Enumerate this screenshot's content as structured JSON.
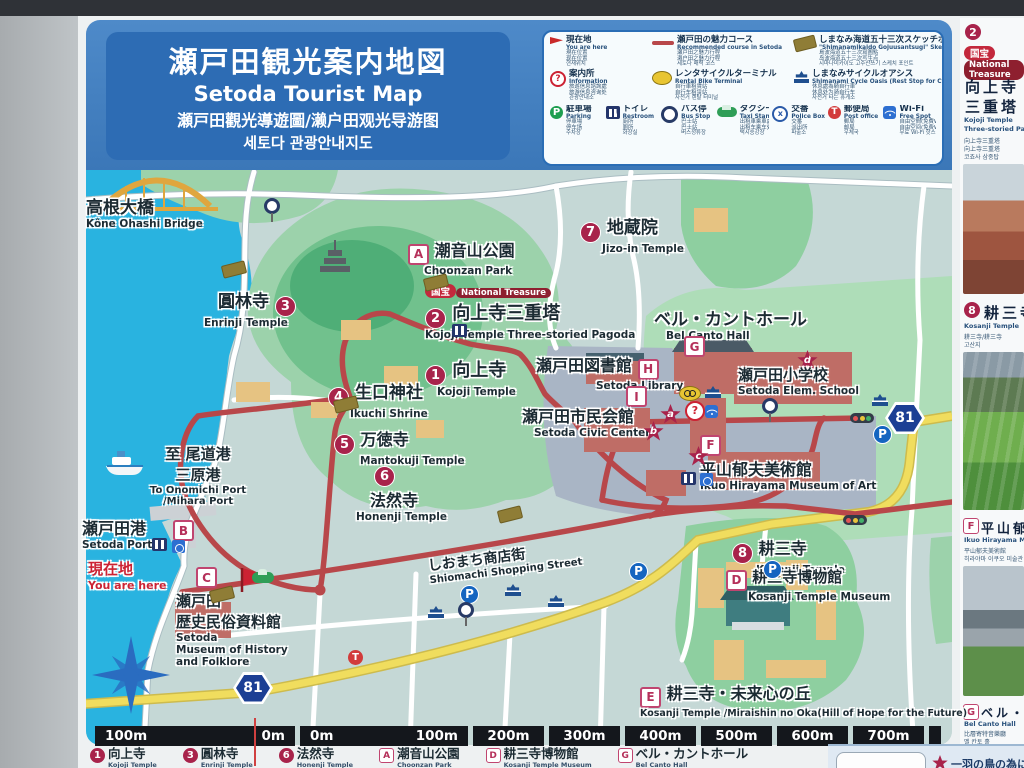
{
  "title": {
    "jp": "瀬戸田観光案内地図",
    "en": "Setoda Tourist Map",
    "zh": "瀬戸田觀光導遊圖/濑户田观光导游图",
    "ko": "세토다 관광안내지도"
  },
  "legend": {
    "main": [
      {
        "icon": "you-are-here",
        "jp": "現在地",
        "en": "You are here",
        "sub": {
          "0": "現在位置",
          "1": "现在位置",
          "2": "현재위치"
        }
      },
      {
        "icon": "course-line",
        "jp": "瀬戸田の魅力コース",
        "en": "Recommended course in Setoda",
        "sub": {
          "0": "瀬戸田之魅力行程",
          "1": "濑户田之魅力行程",
          "2": "세토다 매력 코스"
        }
      },
      {
        "icon": "sketch-point",
        "jp": "しまなみ海道五十三次スケッチポイント",
        "en": "\"Shimanamikaido Gojuusantsugi\" Sketch Point of Ikuo Hirayama",
        "sub": {
          "0": "島波海道五十三次寫圖點",
          "1": "岛波海道五十三次写生点",
          "2": "시마나미카이도 고주산쓰기 스케치 포인트"
        }
      },
      {
        "icon": "information",
        "jp": "案内所",
        "en": "Information",
        "sub": {
          "0": "旅遊信息諮詢處",
          "1": "旅游信息咨询处",
          "2": "관광안내소"
        }
      },
      {
        "icon": "rental-bike",
        "jp": "レンタサイクルターミナル",
        "en": "Rental Bike Terminal",
        "sub": {
          "0": "自行車租賃站",
          "1": "自行车租赁站",
          "2": "자전거 렌탈 터미널"
        }
      },
      {
        "icon": "cycle-oasis",
        "jp": "しまなみサイクルオアシス",
        "en": "Shimanami Cycle Oasis (Rest Stop for Cyclists)",
        "sub": {
          "0": "休息處為騎自行車",
          "1": "休息处为骑自行车",
          "2": "자전거 타는 휴게소"
        }
      }
    ],
    "small": [
      {
        "icon": "parking",
        "jp": "駐車場",
        "en": "Parking",
        "sub": {
          "0": "停車場",
          "1": "停车场",
          "2": "주차장"
        }
      },
      {
        "icon": "restroom",
        "jp": "トイレ",
        "en": "Restroom",
        "sub": {
          "0": "廁所",
          "1": "厕所",
          "2": "화장실"
        }
      },
      {
        "icon": "bus-stop",
        "jp": "バス停",
        "en": "Bus Stop",
        "sub": {
          "0": "巴士站",
          "1": "巴士站",
          "2": "버스정류장"
        }
      },
      {
        "icon": "taxi",
        "jp": "タクシー",
        "en": "Taxi Stand",
        "sub": {
          "0": "出租車乘車處",
          "1": "出租车乘车处",
          "2": "택시승강장"
        }
      },
      {
        "icon": "police-box",
        "jp": "交番",
        "en": "Police Box",
        "sub": {
          "0": "交番",
          "1": "派出所",
          "2": "파출소"
        }
      },
      {
        "icon": "post-office",
        "jp": "郵便局",
        "en": "Post office",
        "sub": {
          "0": "郵局",
          "1": "邮局",
          "2": "우체국"
        }
      },
      {
        "icon": "wifi",
        "jp": "Wi-Fi",
        "en": "Free Spot",
        "sub": {
          "0": "自由空間(免費Wi-Fi)",
          "1": "自由空间(免费Wi-Fi)",
          "2": "무료 Wi-Fi 핫스팟"
        }
      }
    ]
  },
  "map": {
    "route_badge": "81",
    "labels": {
      "bridge": {
        "jp": "高根大橋",
        "en": "Kône Ohashi Bridge"
      },
      "ports": {
        "l1": "至 尾道港",
        "l2": "三原港",
        "l3": "To Onomichi Port",
        "l4": "/Mihara Port"
      },
      "enrinji": {
        "jp": "圓林寺",
        "num": "3",
        "en": "Enrinji Temple"
      },
      "choonzan": {
        "badge": "A",
        "jp": "潮音山公園",
        "en": "Choonzan Park"
      },
      "pagoda": {
        "b1": "国宝",
        "b2": "National Treasure",
        "num": "2",
        "jp": "向上寺三重塔",
        "en": "Kojoji Temple Three-storied Pagoda"
      },
      "kojoji": {
        "num": "1",
        "jp": "向上寺",
        "en": "Kojoji Temple"
      },
      "ikuchi": {
        "num": "4",
        "jp": "生口神社",
        "en": "Ikuchi Shrine"
      },
      "mantokuji": {
        "num": "5",
        "jp": "万徳寺",
        "en": "Mantokuji Temple"
      },
      "honenji": {
        "num": "6",
        "jp": "法然寺",
        "en": "Honenji Temple"
      },
      "jizoin": {
        "num": "7",
        "jp": "地蔵院",
        "en": "Jizo-in Temple"
      },
      "library": {
        "jp": "瀬戸田図書館",
        "badge": "H",
        "en": "Setoda Library"
      },
      "civic": {
        "jp": "瀬戸田市民会館",
        "badge": "I",
        "en": "Setoda Civic Center"
      },
      "belcanto": {
        "jp": "ベル・カントホール",
        "en": "Bel Canto Hall",
        "badge": "G"
      },
      "school": {
        "jp": "瀬戸田小学校",
        "en": "Setoda Elem. School",
        "star": "d"
      },
      "museum": {
        "badge": "F",
        "jp": "平山郁夫美術館",
        "en": "Ikuo Hirayama Museum of Art"
      },
      "port": {
        "jp": "瀬戸田港",
        "en": "Setoda Port",
        "badge": "B"
      },
      "here": {
        "jp": "現在地",
        "en": "You are here"
      },
      "cbadge": "C",
      "history": {
        "jp1": "瀬戸田",
        "jp2": "歴史民俗資料館",
        "en1": "Setoda",
        "en2": "Museum of History",
        "en3": "and Folklore"
      },
      "shopping": {
        "jp": "しおまち商店街",
        "en": "Shiomachi Shopping Street"
      },
      "kosanji": {
        "num": "8",
        "jp": "耕三寺",
        "en": "Kosanji Temple"
      },
      "kosanji_museum": {
        "badge": "D",
        "jp": "耕三寺博物館",
        "en": "Kosanji Temple Museum"
      },
      "miraishin": {
        "badge": "E",
        "jp": "耕三寺・未来心の丘",
        "en": "Kosanji Temple /Miraishin no Oka(Hill of Hope for the Future)"
      },
      "stars": {
        "a": "a",
        "b": "b",
        "c": "c",
        "d": "d"
      }
    }
  },
  "scalebar": {
    "pair_left": {
      "0": "100m",
      "1": "0m"
    },
    "pair_right": {
      "0": "0m",
      "1": "100m"
    },
    "boxes": [
      "200m",
      "300m",
      "400m",
      "500m",
      "600m",
      "700m"
    ]
  },
  "footer": {
    "items": [
      {
        "badge": "1",
        "style": "num",
        "jp": "向上寺",
        "en": "Kojoji Temple"
      },
      {
        "badge": "3",
        "style": "num",
        "jp": "圓林寺",
        "en": "Enrinji Temple"
      },
      {
        "badge": "6",
        "style": "num",
        "jp": "法然寺",
        "en": "Honenji Temple"
      },
      {
        "badge": "A",
        "style": "sq",
        "jp": "潮音山公園",
        "en": "Choonzan Park"
      },
      {
        "badge": "D",
        "style": "sq",
        "jp": "耕三寺博物館",
        "en": "Kosanji Temple Museum"
      },
      {
        "badge": "G",
        "style": "sq",
        "jp": "ベル・カントホール",
        "en": "Bel Canto Hall"
      }
    ],
    "star_note": "一羽の鳥の為に"
  },
  "sidebar": {
    "e1": {
      "num": "2",
      "t1": "国宝",
      "t2": "National Treasure",
      "jp1": "向上寺",
      "jp2": "三重塔",
      "en1": "Kojoji Temple",
      "en2": "Three-storied Pagoda",
      "s1": "向上寺三重塔",
      "s2": "向上寺三重塔",
      "s3": "코죠사 삼중탑"
    },
    "e2": {
      "num": "8",
      "jp": "耕三寺",
      "en": "Kosanji Temple",
      "s1": "耕三寺/耕三寺",
      "s2": "고산지"
    },
    "e3": {
      "badge": "F",
      "jp": "平山郁夫美術館",
      "en": "Ikuo Hirayama Museum of Art",
      "s1": "平山郁夫美術館",
      "s2": "히라야마 이쿠오 미술관"
    },
    "e4": {
      "badge": "G",
      "jp": "ベル・カントホール",
      "en": "Bel Canto Hall",
      "s1": "比層寄特音樂廳",
      "s2": "벨 칸토 홀"
    }
  }
}
